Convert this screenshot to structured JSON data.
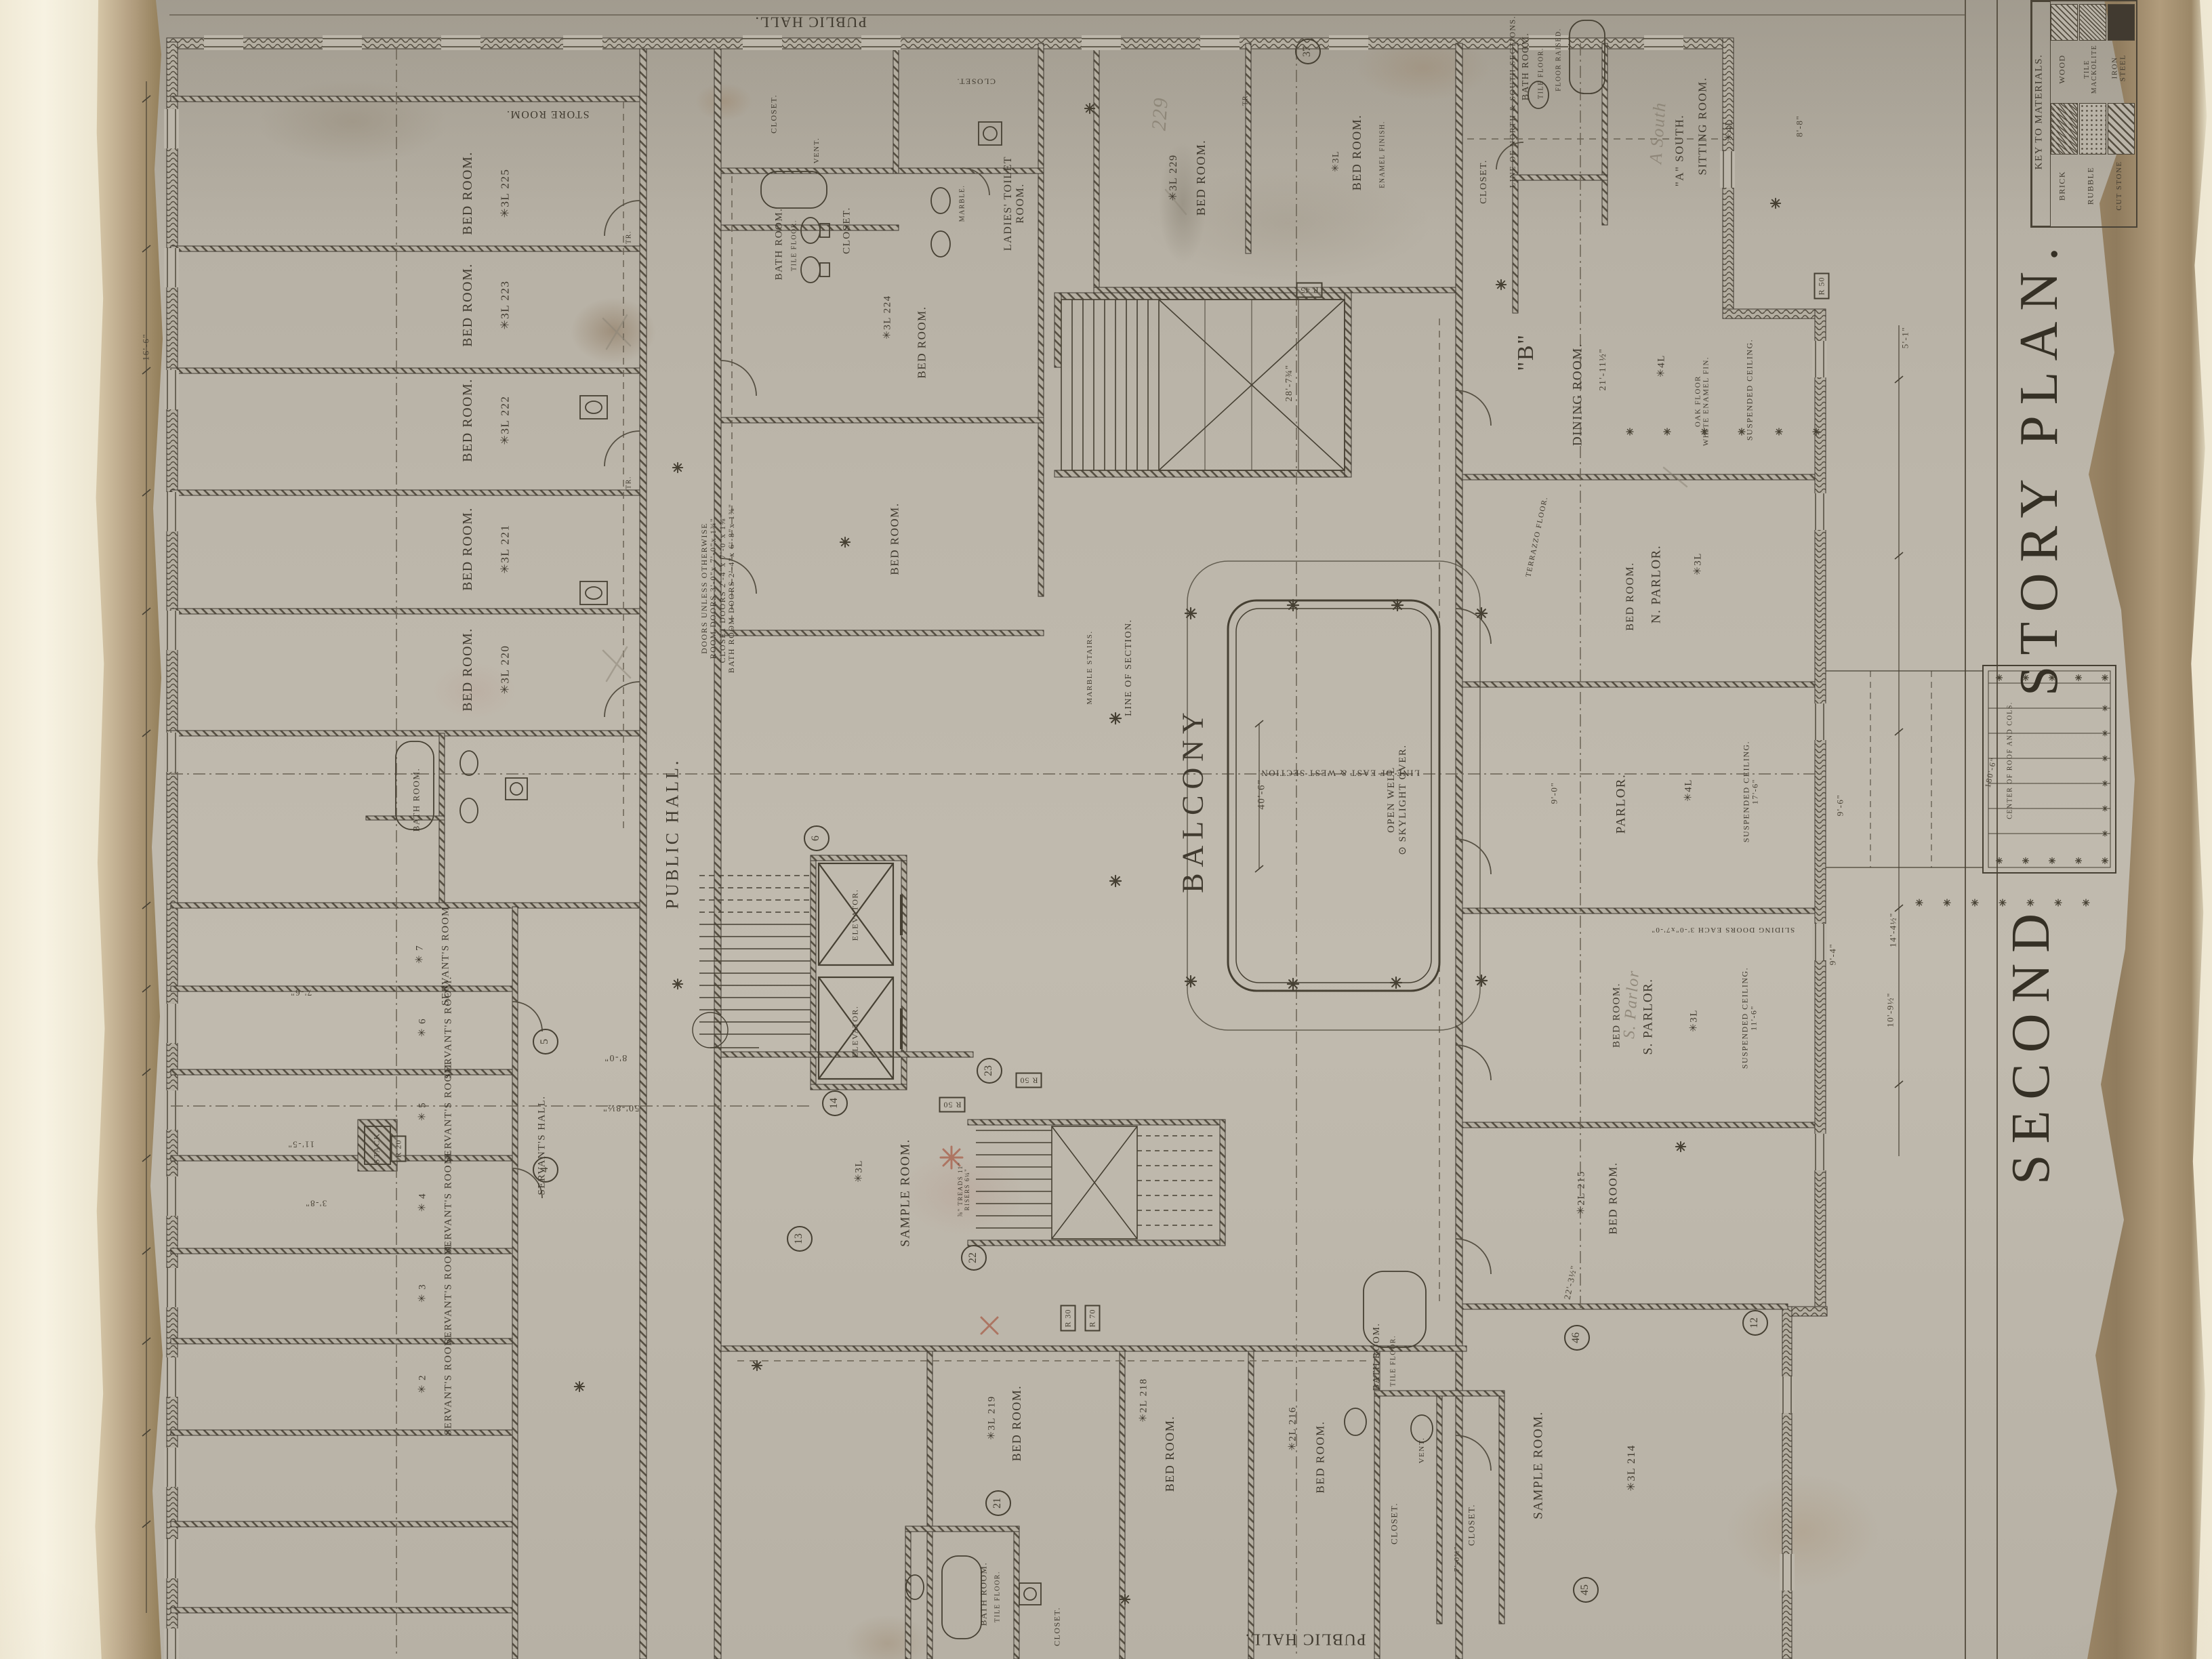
{
  "t": {
    "second": "SECOND",
    "story": "STORY PLAN.",
    "key_title": "KEY TO MATERIALS.",
    "brick": "BRICK",
    "wood": "WOOD",
    "rubble": "RUBBLE",
    "tile": "TILE\nMACKOLITE",
    "cut_stone": "CUT STONE",
    "iron": "IRON\nSTEEL",
    "public_hall": "PUBLIC HALL.",
    "store_room": "STORE ROOM.",
    "bed_room": "BED ROOM.",
    "sample_room": "SAMPLE ROOM.",
    "servants_room": "SERVANT'S ROOM.",
    "servants_hall": "SERVANT'S HALL.",
    "ladies_toilet": "LADIES' TOILET\nROOM.",
    "bath_room": "BATH ROOM.",
    "closet": "CLOSET.",
    "vent": "VENT.",
    "stack": "STACK.",
    "elevator": "ELEVATOR.",
    "balcony": "BALCONY",
    "open_well": "OPEN WELL\n⊙ SKYLIGHT OVER.",
    "dining_room": "DINING ROOM.",
    "n_parlor": "N. PARLOR.",
    "parlor": "PARLOR.",
    "s_parlor": "S. PARLOR.",
    "sitting_room": "SITTING ROOM.",
    "a_south": "\"A\" SOUTH.",
    "stair_b": "\"B\"",
    "tile_floor": "TILE FLOOR.",
    "terrazzo": "TERRAZZO FLOOR.",
    "oak_floor": "OAK FLOOR\nWHITE ENAMEL FIN.",
    "susp_ceiling": "SUSPENDED CEILING.",
    "susp_17": "SUSPENDED CEILING.\n17'-6\"",
    "susp_11": "SUSPENDED CEILING.\n11'-6\"",
    "enamel": "ENAMEL FINISH.",
    "floor_raised": "FLOOR RAISED.",
    "marble": "MARBLE.",
    "marble_stairs": "MARBLE STAIRS.",
    "line_section": "LINE OF SECTION.",
    "line_ew": "LINE OF EAST & WEST SECTION.",
    "line_ns": "LINE OF NORTH & SOUTH SECTIONS.",
    "sliding": "SLIDING DOORS EACH 3'-0\"x7'-0\"",
    "center_roof": "CENTER OF ROOF AND COLS.",
    "door_note": "DOORS UNLESS OTHERWISE\nROOM DOORS 3'-0\"x 7'-0\"x 1¾\"\nCLOSET DOORS 2'-4\"x 7'-0\"x 1⅜\"\nBATH ROOM DOORS 2'-4\"x 6'-8\"x 1⅜\"",
    "treads": "⅞\" TREADS 11\"\nRISERS 6¼\"",
    "tr": "TR.",
    "p229": "229",
    "pa": "A South",
    "psp": "S. Parlor",
    "n225": "✳3L 225",
    "n223": "✳3L 223",
    "n222": "✳3L 222",
    "n221": "✳3L 221",
    "n220": "✳3L 220",
    "n224": "✳3L 224",
    "n229": "✳3L 229",
    "n219": "✳3L 219",
    "n218": "✳2L 218",
    "n216": "✳2L 216",
    "n215": "✳2L 215",
    "n214": "✳3L 214",
    "c3": "✳3L",
    "c4l": "✳4L",
    "s7": "✳ 7",
    "s6": "✳ 6",
    "s5": "✳ 5",
    "s4": "✳ 4",
    "s3": "✳ 3",
    "s2": "✳ 2",
    "d40": "40'-6\"",
    "d28": "28'-7¾\"",
    "d21": "21'-11½\"",
    "d22": "22'-3½\"",
    "d9_6": "9'-6\"",
    "d9_4": "9'-4\"",
    "d9_0": "9'-0\"",
    "d8_8": "8'-8\"",
    "d8_0": "8'-0\"",
    "d50": "50'-8½\"",
    "d7_6": "7'-6\"",
    "d11_5": "11'-5\"",
    "d3_8": "3'-8\"",
    "d16": "16'-6\"",
    "d5_1": "5'-1\"",
    "d14": "14'-4½\"",
    "d10": "10'-9½\"",
    "d180": "180'-6\"",
    "d7_0": "7'-0½\"",
    "r20": "R 20",
    "r30": "R 30",
    "r45": "R 45",
    "r50": "R 50",
    "r70": "R 70",
    "m4": "4",
    "m5": "5",
    "m6": "6",
    "m12": "12",
    "m13": "13",
    "m14": "14",
    "m21": "21",
    "m22": "22",
    "m23": "23",
    "m37": "37",
    "m45": "45",
    "m46": "46"
  }
}
